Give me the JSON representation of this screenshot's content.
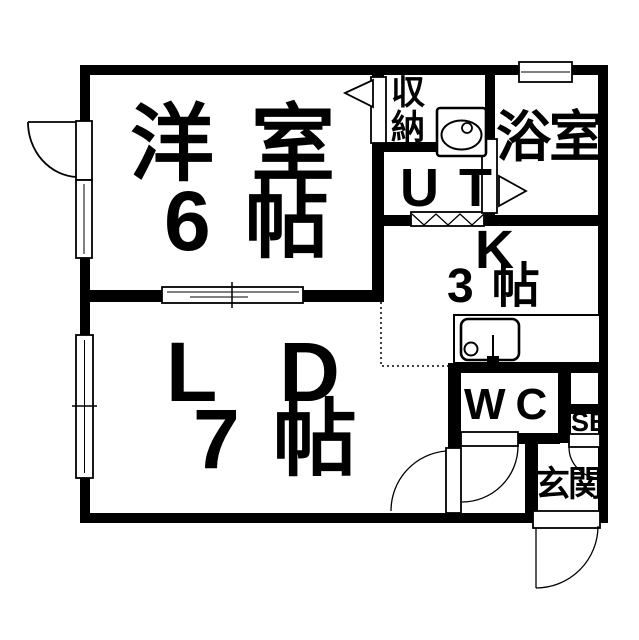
{
  "title": "apartment-floor-plan",
  "colors": {
    "background": "#ffffff",
    "line": "#000000"
  },
  "labels": [
    {
      "id": "yoshitsu-name",
      "text": "洋室"
    },
    {
      "id": "yoshitsu-size",
      "text": "6帖"
    },
    {
      "id": "ld-name",
      "text": "LD"
    },
    {
      "id": "ld-size",
      "text": "7帖"
    },
    {
      "id": "closet",
      "text": "収納"
    },
    {
      "id": "utility",
      "text": "UT"
    },
    {
      "id": "bathroom",
      "text": "浴室"
    },
    {
      "id": "kitchen-name",
      "text": "K"
    },
    {
      "id": "kitchen-size",
      "text": "3帖"
    },
    {
      "id": "wc",
      "text": "WC"
    },
    {
      "id": "shoe-box",
      "text": "SB"
    },
    {
      "id": "entrance",
      "text": "玄関"
    }
  ],
  "fixtures": [
    "washbasin",
    "kitchen-sink-counter",
    "burner",
    "faucet",
    "accordion-door",
    "sliding-door",
    "hinged-doors",
    "windows"
  ]
}
